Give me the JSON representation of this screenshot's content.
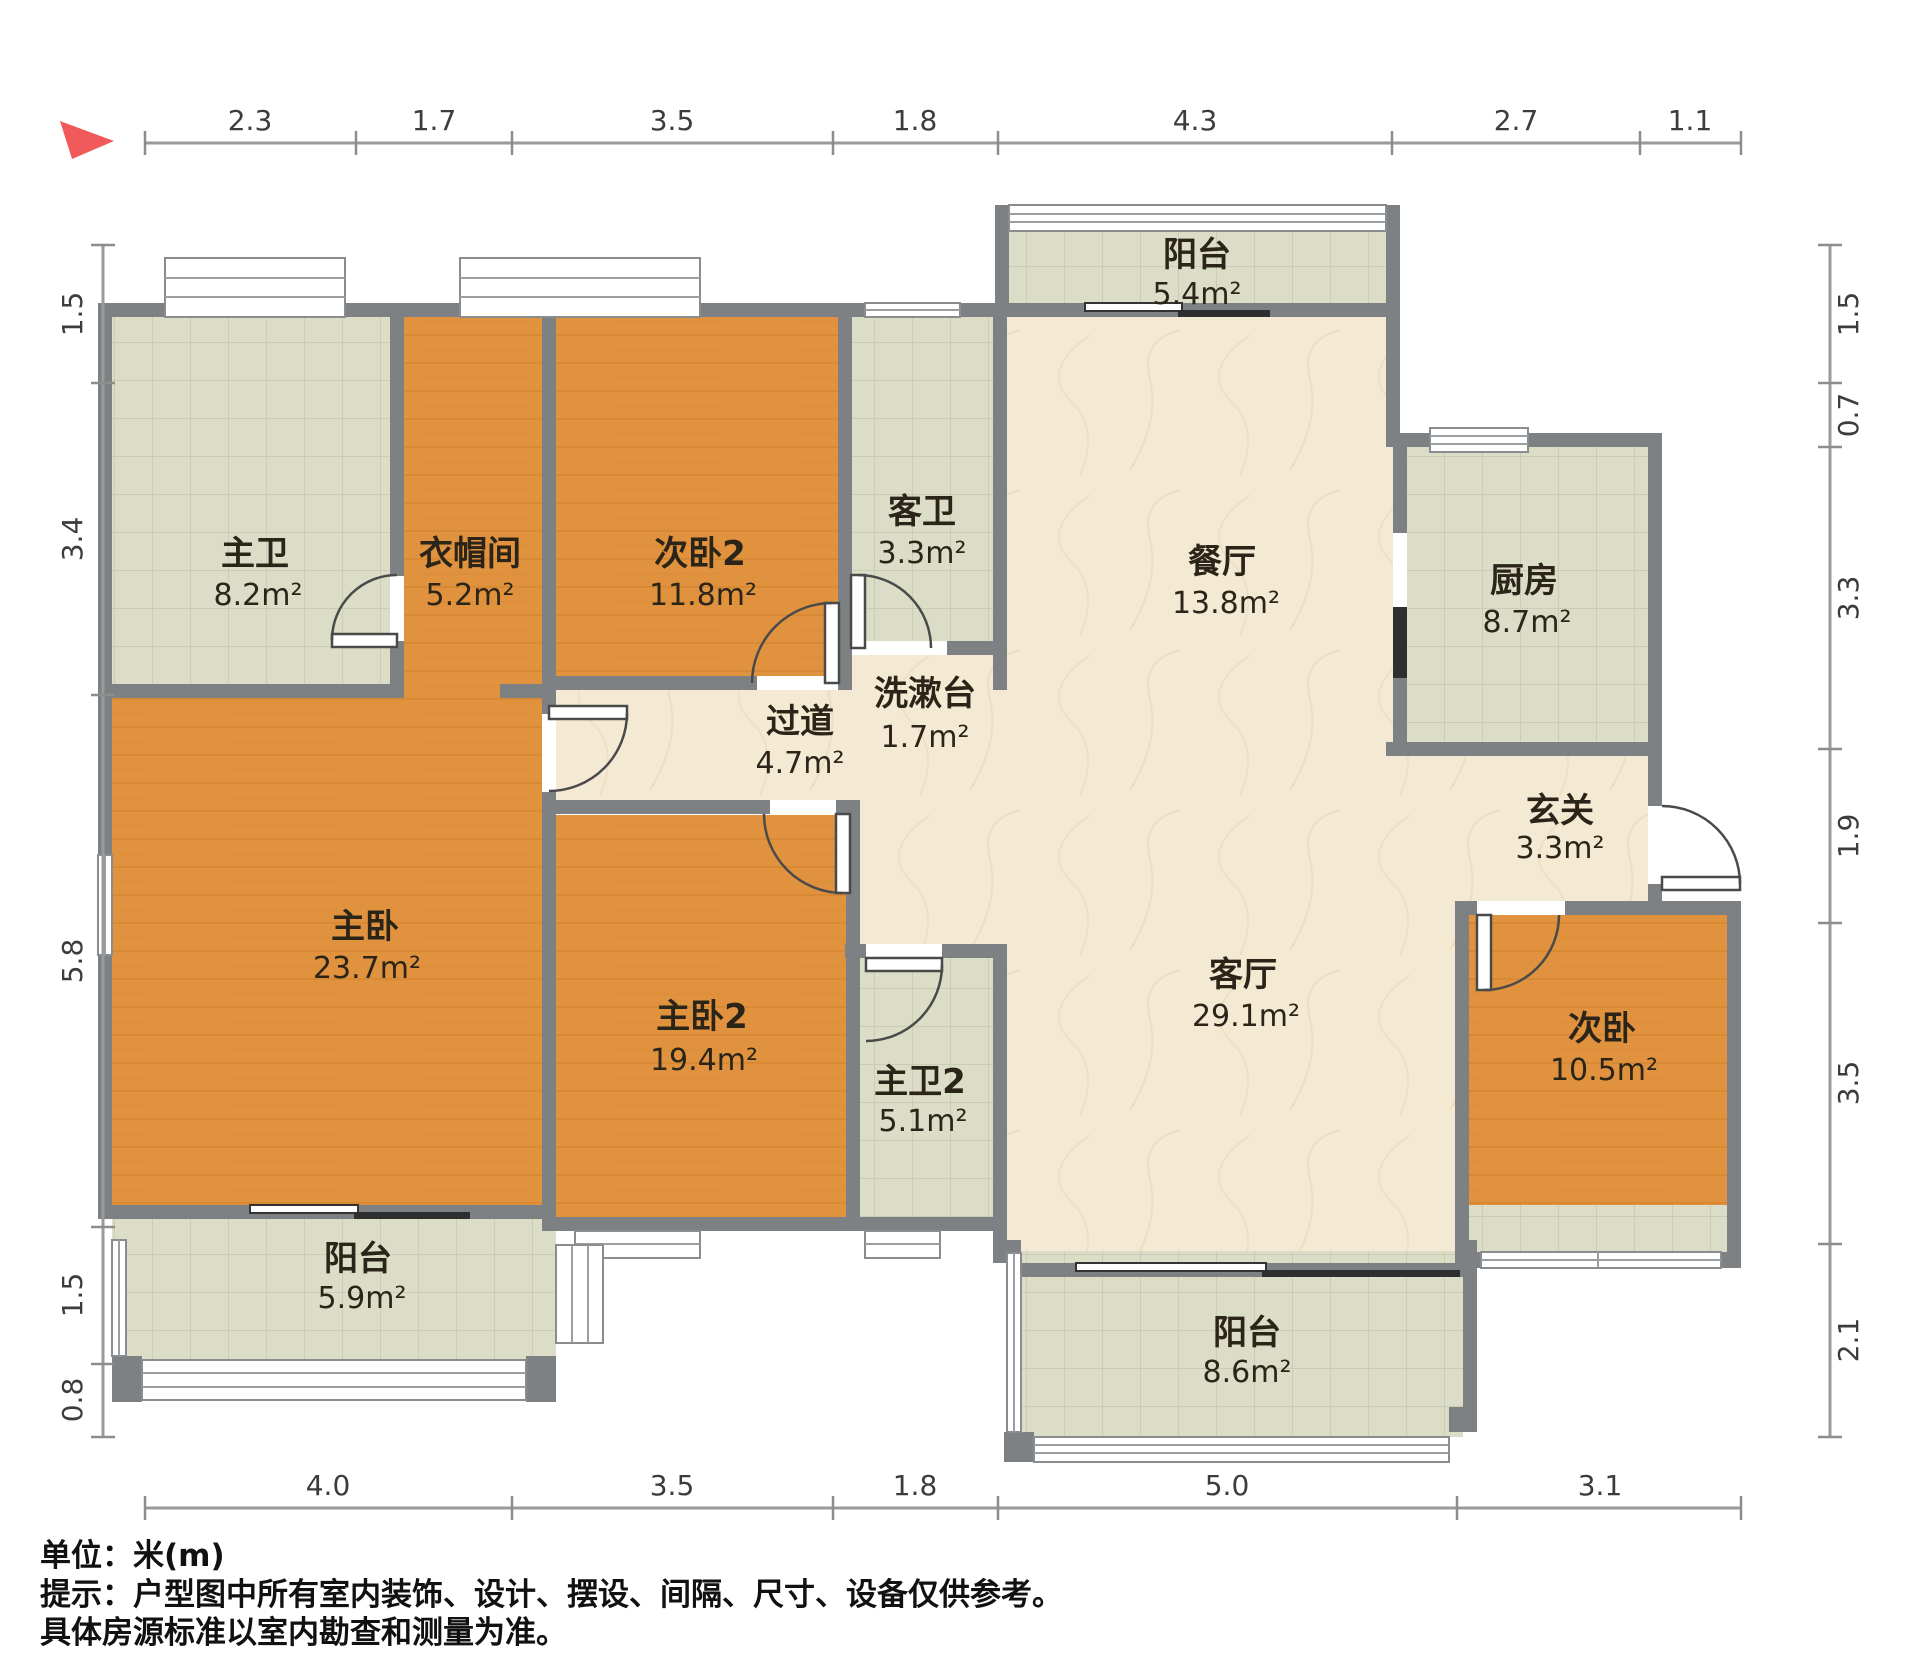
{
  "notes": {
    "unit": "单位：米(m)",
    "tip_line1": "提示：户型图中所有室内装饰、设计、摆设、间隔、尺寸、设备仅供参考。",
    "tip_line2": "具体房源标准以室内勘查和测量为准。"
  },
  "colors": {
    "wall": "#7e8183",
    "tile_floor": "#dcddc6",
    "wood_floor": "#e0923e",
    "marble_floor": "#f4ead4",
    "north_arrow": "#f05a5a"
  },
  "dimensions": {
    "top": [
      "2.3",
      "1.7",
      "3.5",
      "1.8",
      "4.3",
      "2.7",
      "1.1"
    ],
    "bottom": [
      "4.0",
      "3.5",
      "1.8",
      "5.0",
      "3.1"
    ],
    "left": [
      "1.5",
      "3.4",
      "5.8",
      "1.5",
      "0.8"
    ],
    "right": [
      "1.5",
      "0.7",
      "3.3",
      "1.9",
      "3.5",
      "2.1"
    ]
  },
  "rooms": {
    "balcony_top": {
      "name": "阳台",
      "area": "5.4m²"
    },
    "master_bath": {
      "name": "主卫",
      "area": "8.2m²"
    },
    "cloakroom": {
      "name": "衣帽间",
      "area": "5.2m²"
    },
    "bedroom2_2": {
      "name": "次卧2",
      "area": "11.8m²"
    },
    "guest_bath": {
      "name": "客卫",
      "area": "3.3m²"
    },
    "dining": {
      "name": "餐厅",
      "area": "13.8m²"
    },
    "kitchen": {
      "name": "厨房",
      "area": "8.7m²"
    },
    "washstand": {
      "name": "洗漱台",
      "area": "1.7m²"
    },
    "hallway": {
      "name": "过道",
      "area": "4.7m²"
    },
    "foyer": {
      "name": "玄关",
      "area": "3.3m²"
    },
    "master_bedroom": {
      "name": "主卧",
      "area": "23.7m²"
    },
    "master_bedroom2": {
      "name": "主卧2",
      "area": "19.4m²"
    },
    "master_bath2": {
      "name": "主卫2",
      "area": "5.1m²"
    },
    "living": {
      "name": "客厅",
      "area": "29.1m²"
    },
    "bedroom2": {
      "name": "次卧",
      "area": "10.5m²"
    },
    "balcony_left": {
      "name": "阳台",
      "area": "5.9m²"
    },
    "balcony_bottom": {
      "name": "阳台",
      "area": "8.6m²"
    }
  }
}
